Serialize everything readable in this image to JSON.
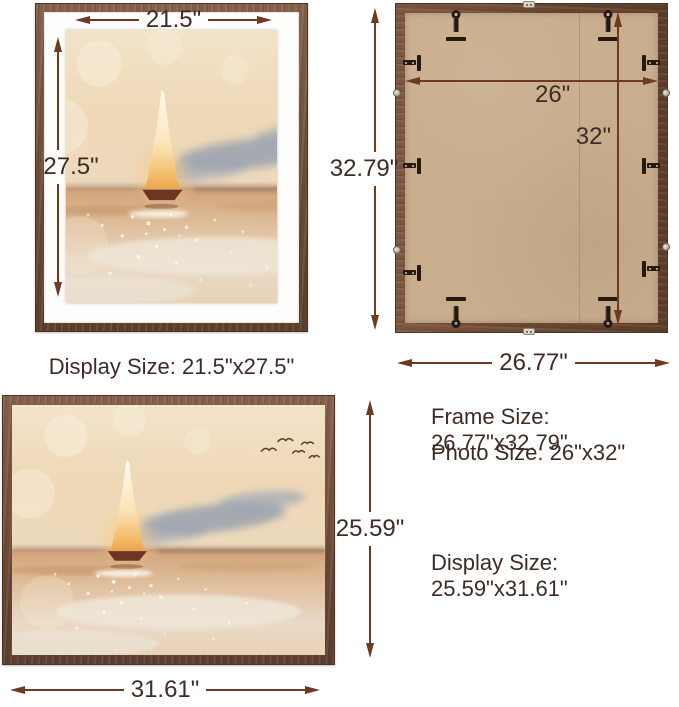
{
  "portrait_view": {
    "width": "21.5\"",
    "height": "27.5\"",
    "caption": "Display Size: 21.5\"x27.5\""
  },
  "back_view": {
    "photo_width": "26\"",
    "photo_height": "32\"",
    "frame_height": "32.79\"",
    "frame_width": "26.77\""
  },
  "landscape_view": {
    "height": "25.59\"",
    "width": "31.61\""
  },
  "specs": {
    "frame_size": "Frame Size: 26.77\"x32.79\"",
    "photo_size": "Photo Size: 26\"x32\"",
    "display_size": "Display Size: 25.59\"x31.61\""
  },
  "icons": {
    "hanger": "d-ring-hanger",
    "clip": "turn-button-clip",
    "screw": "screw",
    "bracket": "metal-bracket",
    "arrows": "double-headed-dimension-arrow"
  },
  "colors": {
    "arrow_line": "#6e3a20",
    "label_text": "#3e2c24",
    "frame_wood": "#6e4b36",
    "mat": "#fdfdfc",
    "backing_board": "#c9ae8d",
    "hardware": "#241a10",
    "background": "#ffffff"
  }
}
